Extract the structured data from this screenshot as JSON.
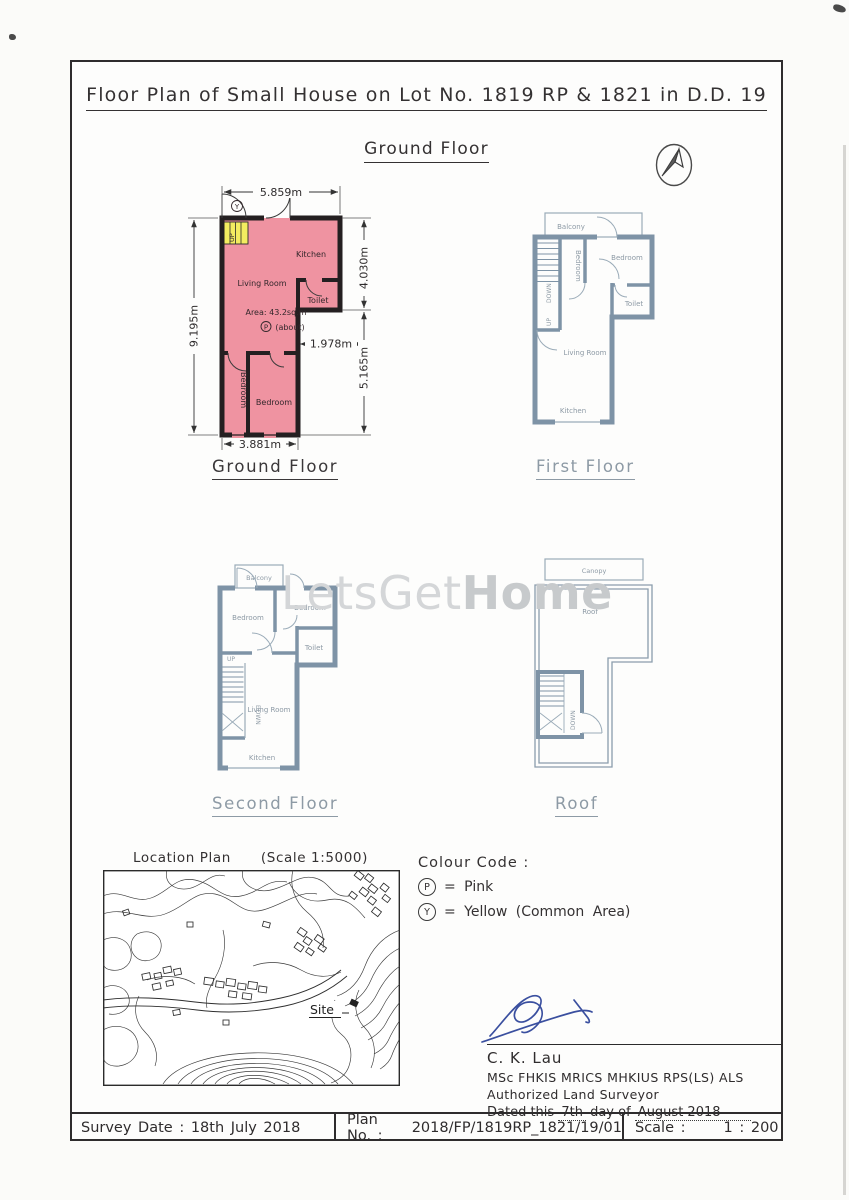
{
  "sheet": {
    "title": "Floor Plan of Small House on Lot No. 1819 RP & 1821 in D.D. 19",
    "subtitle": "Ground Floor"
  },
  "watermark": {
    "light": "LetsGet",
    "bold": "Home"
  },
  "plans": {
    "ground": {
      "caption": "Ground Floor",
      "rooms": {
        "kitchen": "Kitchen",
        "living": "Living Room",
        "toilet": "Toilet",
        "bedroom_a": "Bedroom",
        "bedroom_b": "Bedroom"
      },
      "stair_up": "UP",
      "common_symbol": "Y",
      "area_symbol": "P",
      "area_line1": "Area: 43.2sq.m",
      "area_line2": "(about)",
      "dimensions": {
        "top": "5.859m",
        "left": "9.195m",
        "right_upper": "4.030m",
        "right_lower": "5.165m",
        "inner": "1.978m",
        "bottom": "3.881m"
      }
    },
    "first": {
      "caption": "First Floor",
      "rooms": {
        "balcony": "Balcony",
        "bedroom_a": "Bedroom",
        "bedroom_b": "Bedroom",
        "toilet": "Toilet",
        "living": "Living Room",
        "kitchen": "Kitchen"
      },
      "stair_down": "DOWN",
      "stair_up": "UP"
    },
    "second": {
      "caption": "Second Floor",
      "rooms": {
        "balcony": "Balcony",
        "bedroom_a": "Bedroom",
        "bedroom_b": "Bedroom",
        "toilet": "Toilet",
        "living": "Living Room",
        "kitchen": "Kitchen"
      },
      "stair_up": "UP",
      "stair_down": "DOWN"
    },
    "roof": {
      "caption": "Roof",
      "rooms": {
        "canopy": "Canopy",
        "roof": "Roof"
      },
      "stair_down": "DOWN"
    }
  },
  "location_plan": {
    "title": "Location Plan",
    "scale_note": "(Scale 1:5000)",
    "site_label": "Site"
  },
  "colour_code": {
    "title": "Colour Code :",
    "pink_symbol": "P",
    "pink_text": "= Pink",
    "yellow_symbol": "Y",
    "yellow_text": "= Yellow (Common Area)"
  },
  "surveyor": {
    "name": "C. K. Lau",
    "qualifications": "MSc FHKIS MRICS MHKIUS RPS(LS) ALS",
    "role": "Authorized Land Surveyor",
    "dated_prefix": "Dated this",
    "dated_day": "7th",
    "dated_infix": "day of",
    "dated_value": "August 2018"
  },
  "footer": {
    "survey_date_label": "Survey Date :",
    "survey_date_value": "18th July 2018",
    "plan_no_label": "Plan No. :",
    "plan_no_value": "2018/FP/1819RP_1821/19/01",
    "scale_label": "Scale :",
    "scale_value": "1 : 200"
  },
  "colors": {
    "pink_fill": "#ef93a1",
    "yellow_fill": "#f3ec60",
    "wall_dark": "#241f21",
    "wall_blue": "#7e93a6",
    "line_blue": "#93a5b3",
    "label_gray": "#8d9aa5",
    "ink": "#2f2c2d",
    "signature_blue": "#3a4f9f"
  }
}
